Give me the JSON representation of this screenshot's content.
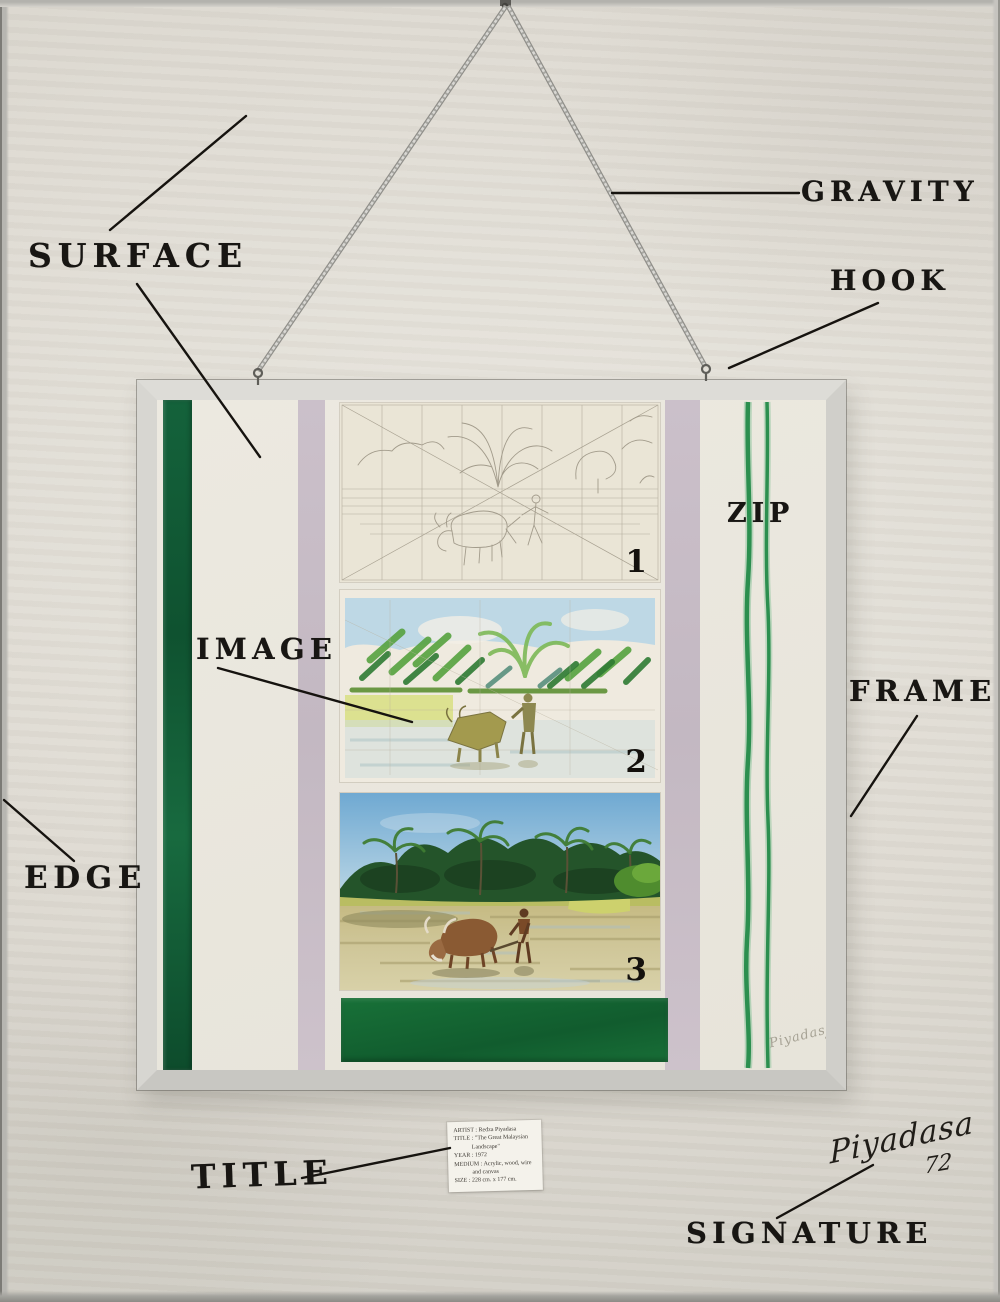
{
  "artwork": {
    "labels": {
      "surface": "SURFACE",
      "gravity": "GRAVITY",
      "hook": "HOOK",
      "zip": "ZIP",
      "image": "IMAGE",
      "frame": "FRAME",
      "edge": "EDGE",
      "title": "TITLE",
      "signature": "SIGNATURE"
    },
    "panel_numbers": [
      "1",
      "2",
      "3"
    ],
    "title_card": {
      "lines": [
        "ARTIST : Redza Piyadasa",
        "TITLE : \"The Great Malaysian",
        "Landscape\"",
        "YEAR : 1972",
        "MEDIUM : Acrylic, wood, wire",
        "and canvas",
        "SIZE : 228 cm. x 177 cm."
      ]
    },
    "signature_script": {
      "name": "Piyadasa",
      "year": "72"
    },
    "canvas_signature": {
      "name": "Piyadasa",
      "year": "72"
    },
    "colors": {
      "wall": "#dedad2",
      "frame": "#d7d6d1",
      "canvas_white": "#eae6dd",
      "stripe_green": "#14623b",
      "stripe_mauve": "#c7bcc6",
      "zip_green": "#2c8f4f",
      "bottom_block_green": "#156a38",
      "label_ink": "#181613"
    }
  }
}
